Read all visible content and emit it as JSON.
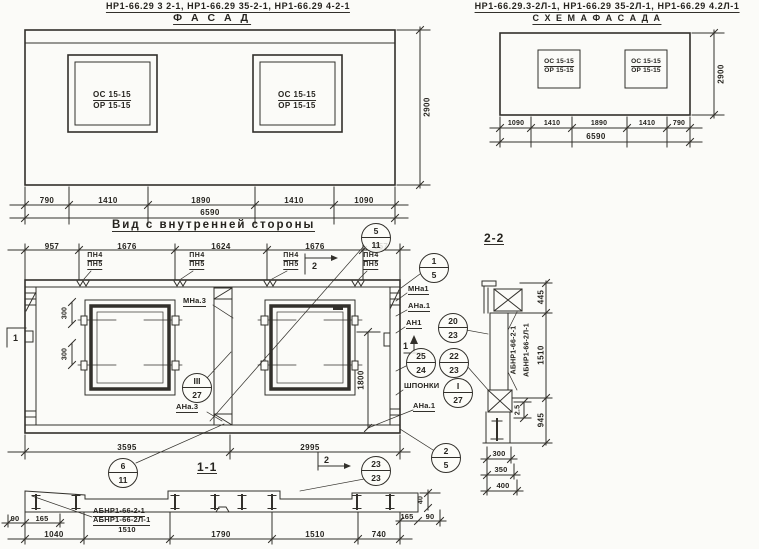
{
  "drawing": {
    "facade": {
      "codes": "НР1-66.29 3 2-1, НР1-66.29 35-2-1, НР1-66.29 4-2-1",
      "title": "Ф А С А Д",
      "window_top": "ОС 15-15",
      "window_bottom": "ОР 15-15",
      "height": "2900",
      "dims_bottom": [
        "790",
        "1410",
        "1890",
        "1410",
        "1090"
      ],
      "total": "6590"
    },
    "schema": {
      "codes": "НР1-66.29.3-2Л-1, НР1-66.29 35-2Л-1, НР1-66.29 4.2Л-1",
      "title": "С Х Е М А   Ф А С А Д А",
      "window_top": "ОС 15-15",
      "window_bottom": "ОР 15-15",
      "height": "2900",
      "dims_bottom": [
        "1090",
        "1410",
        "1890",
        "1410",
        "790"
      ],
      "total": "6590"
    },
    "inner": {
      "title": "Вид с внутренней стороны",
      "dims_top": [
        "957",
        "1676",
        "1624",
        "1676",
        "657"
      ],
      "pn4": "ПН4",
      "pn5": "ПН5",
      "dim_300": "300",
      "dim_1800": "1800",
      "dims_bottom": [
        "3595",
        "2995"
      ],
      "labels": {
        "mna3": "МНа.3",
        "ana3": "АНа.3",
        "mna1": "МНа1",
        "ana1": "АНа.1",
        "an1": "АН1",
        "shponki": "ШПОНКИ",
        "ana1b": "АНа.1"
      },
      "section_label": "1-1"
    },
    "markers": {
      "m1": "1",
      "m2": "2"
    },
    "balloons": {
      "b5_11": {
        "top": "5",
        "bottom": "11"
      },
      "b1_5": {
        "top": "1",
        "bottom": "5"
      },
      "b20_23": {
        "top": "20",
        "bottom": "23"
      },
      "b25_24": {
        "top": "25",
        "bottom": "24"
      },
      "b22_23": {
        "top": "22",
        "bottom": "23"
      },
      "bIII_27": {
        "top": "III",
        "bottom": "27"
      },
      "bI_27": {
        "top": "I",
        "bottom": "27"
      },
      "b2_5": {
        "top": "2",
        "bottom": "5"
      },
      "b6_11": {
        "top": "6",
        "bottom": "11"
      },
      "b23_23": {
        "top": "23",
        "bottom": "23"
      }
    },
    "section22": {
      "title": "2-2",
      "code_a": "АБНР1-66-2-1",
      "code_b": "АБНР1-66-2Л-1",
      "dims": [
        "445",
        "1510",
        "945"
      ],
      "dim_gap": "2.5",
      "stack": [
        "300",
        "350",
        "400"
      ]
    },
    "section11": {
      "dims_left": [
        "90",
        "165"
      ],
      "code_a": "АБНР1-66-2-1",
      "code_b": "АБНР1-66-2Л-1",
      "dims_bottom": [
        "1040",
        "1510",
        "1790",
        "1510",
        "740"
      ],
      "dims_right": [
        "165",
        "90"
      ],
      "dim_40": "40"
    }
  }
}
